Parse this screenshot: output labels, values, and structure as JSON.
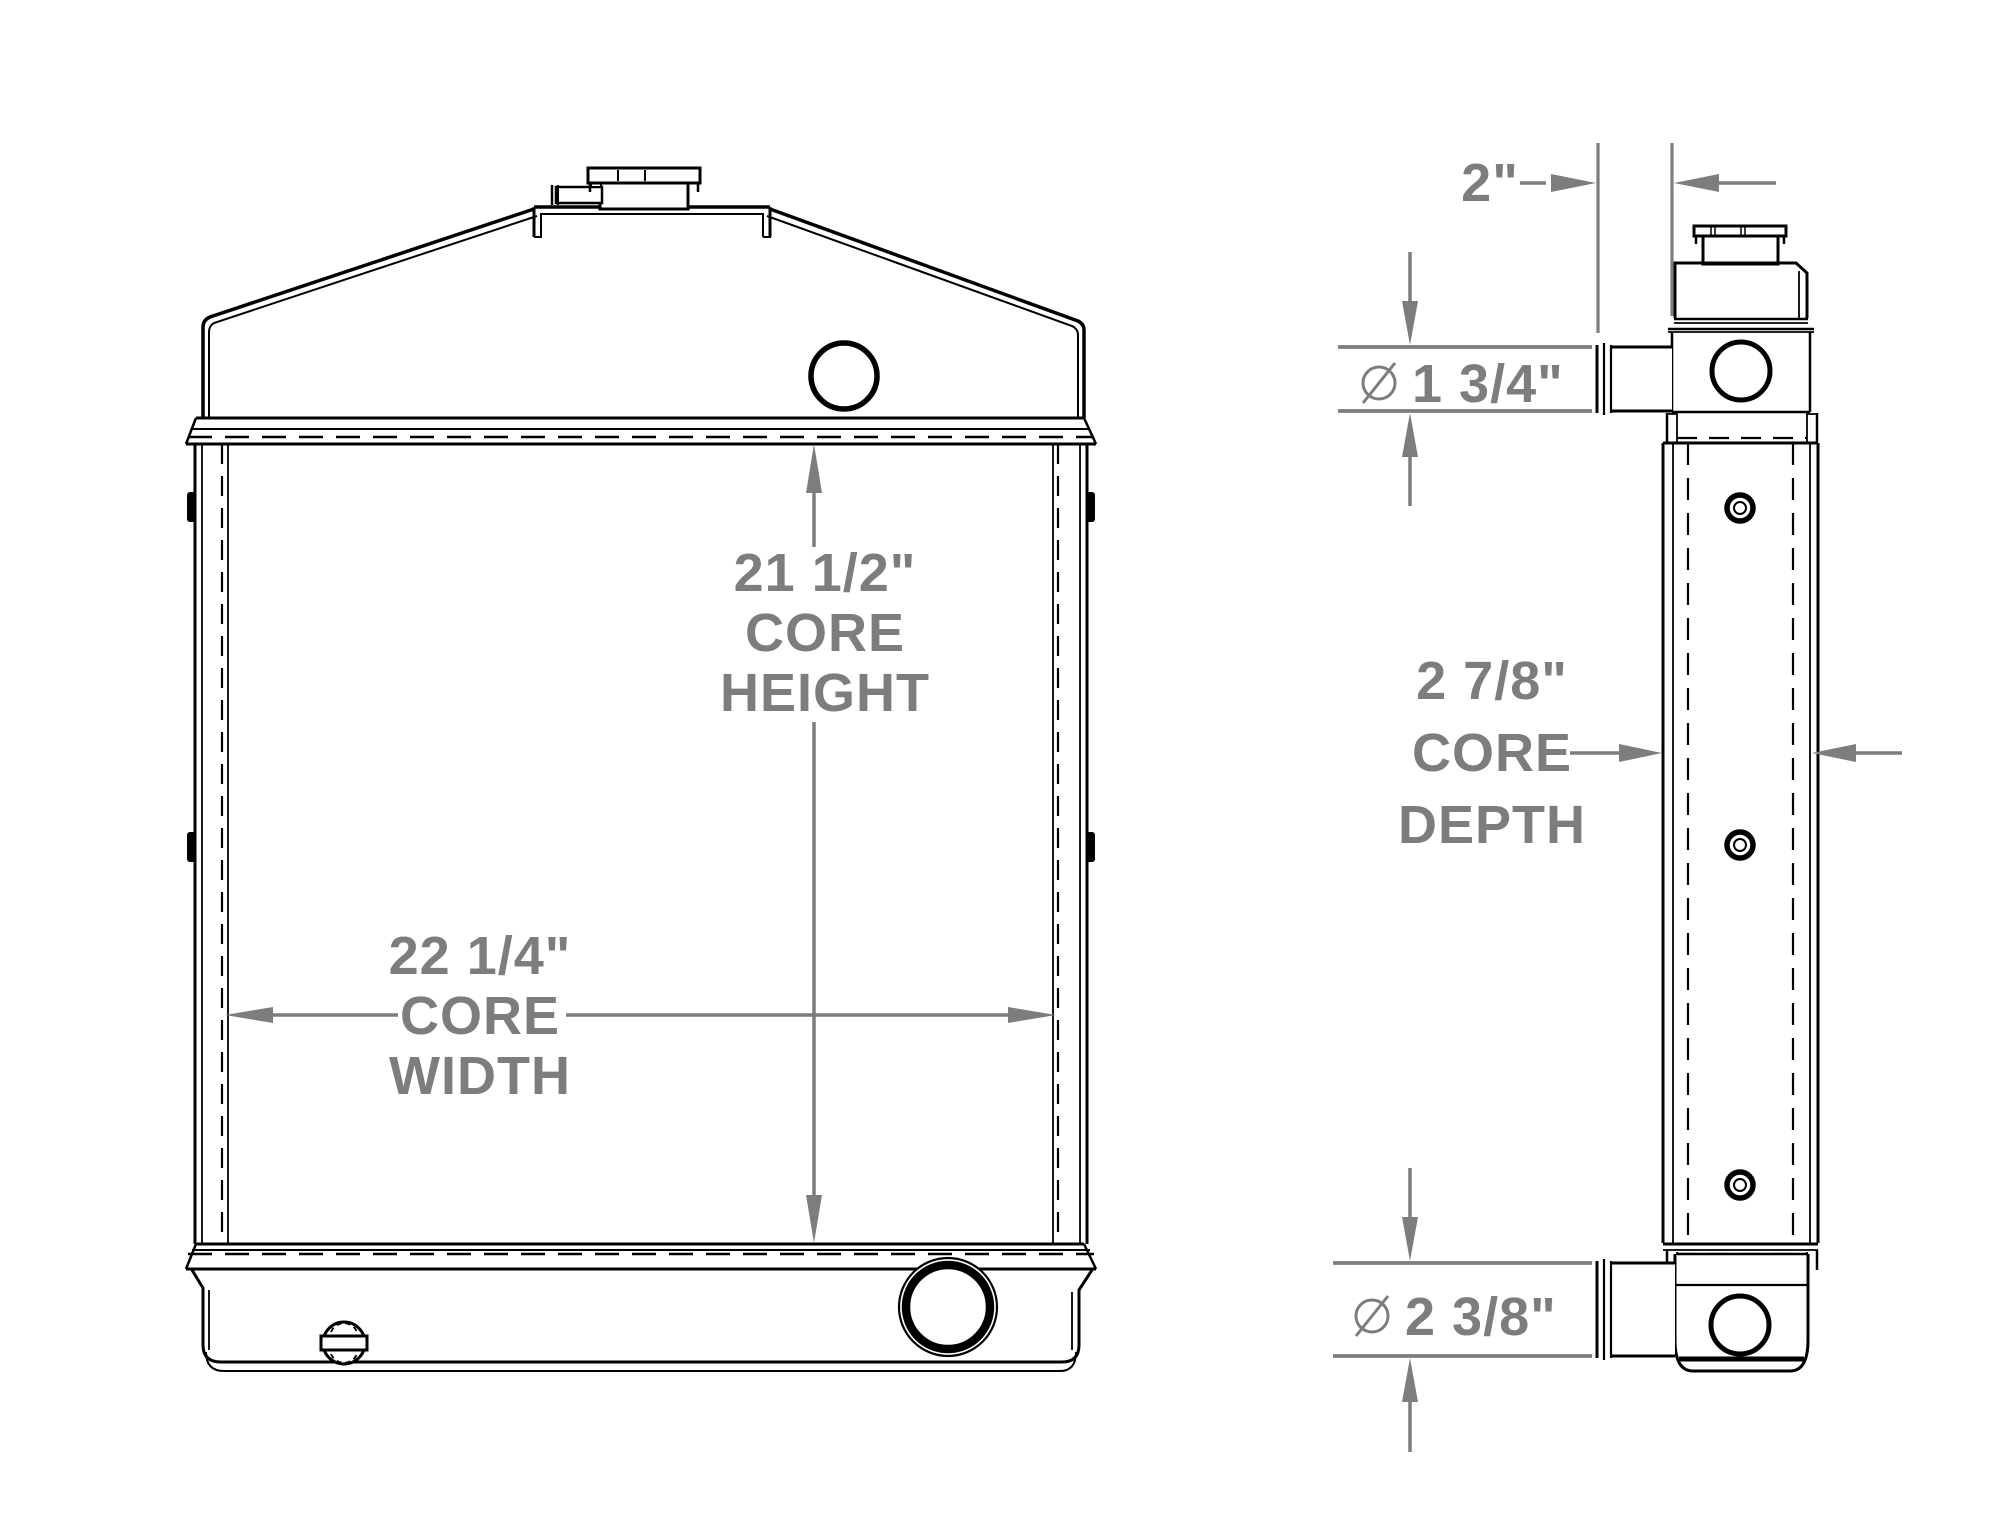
{
  "drawing": {
    "type": "radiator-dimension-drawing",
    "background_color": "#ffffff",
    "line_color": "#000000",
    "dimension_color": "#7d7d7d",
    "views": [
      "front-view",
      "side-view"
    ]
  },
  "dimensions": {
    "core_height": {
      "value": "21 1/2\"",
      "line1": "CORE",
      "line2": "HEIGHT"
    },
    "core_width": {
      "value": "22 1/4\"",
      "line1": "CORE",
      "line2": "WIDTH"
    },
    "core_depth": {
      "value": "2 7/8\"",
      "line1": "CORE",
      "line2": "DEPTH"
    },
    "top_tank_offset": {
      "value": "2\""
    },
    "upper_outlet_diameter": {
      "symbol": "⌀",
      "value": "1 3/4\""
    },
    "lower_outlet_diameter": {
      "symbol": "⌀",
      "value": "2 3/8\""
    }
  }
}
